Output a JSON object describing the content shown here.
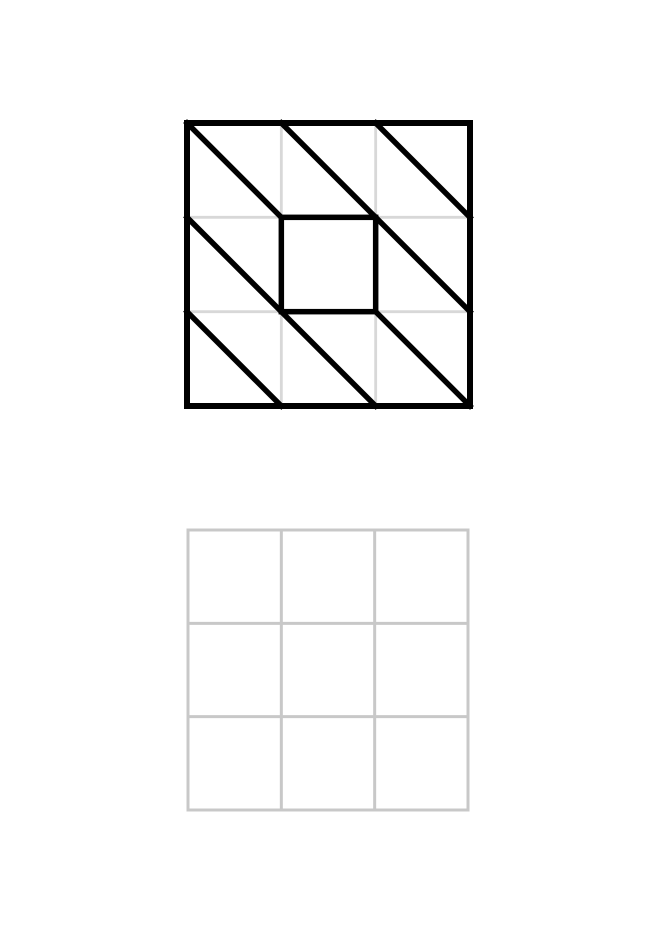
{
  "page": {
    "width": 656,
    "height": 927,
    "background": "#ffffff"
  },
  "colors": {
    "pattern_stroke": "#000000",
    "guide_grid_stroke": "#d8d8d8",
    "copy_grid_stroke": "#c8c8c8",
    "cell_fill": "#ffffff"
  },
  "pattern_figure": {
    "x": 187,
    "y": 123,
    "width": 283,
    "height": 283,
    "rows": 3,
    "cols": 3,
    "border_stroke_width": 6,
    "pattern_stroke_width": 5.5,
    "guide_stroke_width": 2.8,
    "diagonals": [
      {
        "from": [
          0,
          0
        ],
        "to": [
          1,
          1
        ]
      },
      {
        "from": [
          1,
          0
        ],
        "to": [
          2,
          1
        ]
      },
      {
        "from": [
          2,
          0
        ],
        "to": [
          3,
          1
        ]
      },
      {
        "from": [
          0,
          1
        ],
        "to": [
          1,
          2
        ]
      },
      {
        "from": [
          2,
          1
        ],
        "to": [
          3,
          2
        ]
      },
      {
        "from": [
          0,
          2
        ],
        "to": [
          1,
          3
        ]
      },
      {
        "from": [
          1,
          2
        ],
        "to": [
          2,
          3
        ]
      },
      {
        "from": [
          2,
          2
        ],
        "to": [
          3,
          3
        ]
      }
    ],
    "center_square": {
      "col": 1,
      "row": 1,
      "col_span": 1,
      "row_span": 1
    }
  },
  "copy_figure": {
    "x": 188,
    "y": 530,
    "width": 280,
    "height": 280,
    "rows": 3,
    "cols": 3,
    "stroke_width": 3,
    "empty": true
  }
}
